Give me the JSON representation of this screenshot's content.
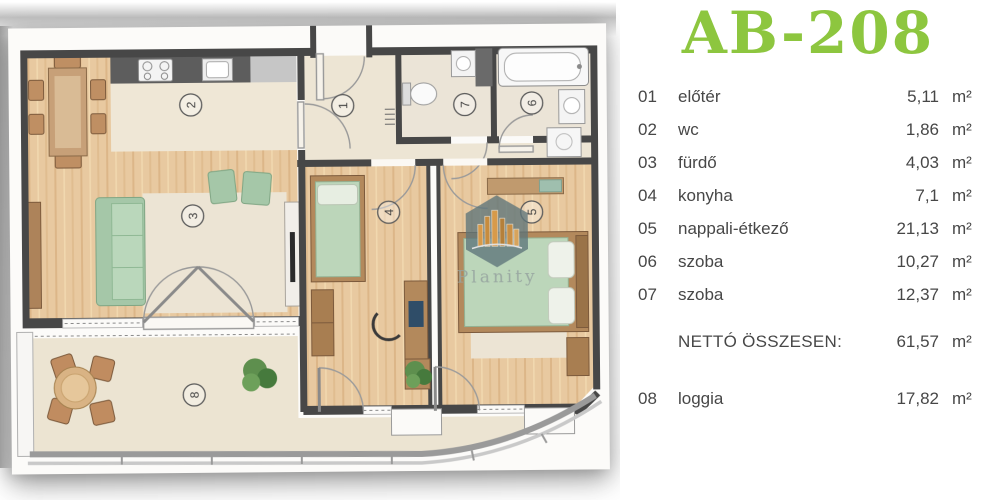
{
  "title": "AB-208",
  "accent_color": "#8dc63f",
  "legend": {
    "rooms": [
      {
        "num": "01",
        "name": "előtér",
        "area": "5,11",
        "unit": "m²"
      },
      {
        "num": "02",
        "name": "wc",
        "area": "1,86",
        "unit": "m²"
      },
      {
        "num": "03",
        "name": "fürdő",
        "area": "4,03",
        "unit": "m²"
      },
      {
        "num": "04",
        "name": "konyha",
        "area": "7,1",
        "unit": "m²"
      },
      {
        "num": "05",
        "name": "nappali-étkező",
        "area": "21,13",
        "unit": "m²"
      },
      {
        "num": "06",
        "name": "szoba",
        "area": "10,27",
        "unit": "m²"
      },
      {
        "num": "07",
        "name": "szoba",
        "area": "12,37",
        "unit": "m²"
      }
    ],
    "total": {
      "label": "NETTÓ ÖSSZESEN:",
      "area": "61,57",
      "unit": "m²"
    },
    "loggia": {
      "num": "08",
      "name": "loggia",
      "area": "17,82",
      "unit": "m²"
    }
  },
  "plan": {
    "watermark": "Planity",
    "markers": [
      {
        "label": "1"
      },
      {
        "label": "2"
      },
      {
        "label": "3"
      },
      {
        "label": "4"
      },
      {
        "label": "5"
      },
      {
        "label": "6"
      },
      {
        "label": "7"
      },
      {
        "label": "8"
      }
    ]
  }
}
